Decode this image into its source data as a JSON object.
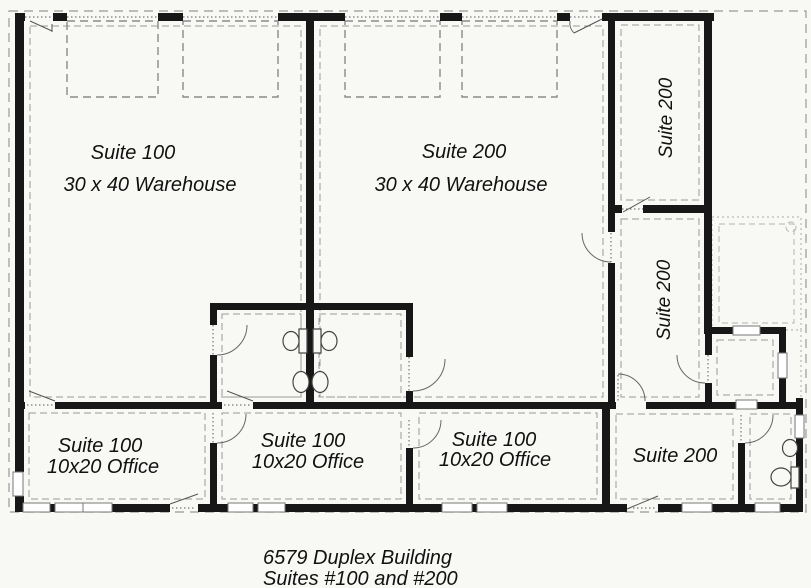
{
  "rooms": {
    "warehouse_100": {
      "title": "Suite 100",
      "size": "30 x 40 Warehouse"
    },
    "warehouse_200": {
      "title": "Suite 200",
      "size": "30 x 40 Warehouse"
    },
    "suite200_upper_room": {
      "title": "Suite 200"
    },
    "suite200_lower_room": {
      "title": "Suite 200"
    },
    "office1": {
      "title": "Suite 100",
      "size": "10x20 Office"
    },
    "office2": {
      "title": "Suite 100",
      "size": "10x20 Office"
    },
    "office3": {
      "title": "Suite 100",
      "size": "10x20 Office"
    },
    "suite200_office": {
      "title": "Suite 200"
    }
  },
  "caption": {
    "line1": "6579 Duplex Building",
    "line2": "Suites #100 and #200"
  },
  "colors": {
    "wall": "#171717",
    "dashed_line": "#8f8f8f",
    "thin_line": "#666666",
    "paper": "#f8f8f5",
    "text": "#111111"
  }
}
